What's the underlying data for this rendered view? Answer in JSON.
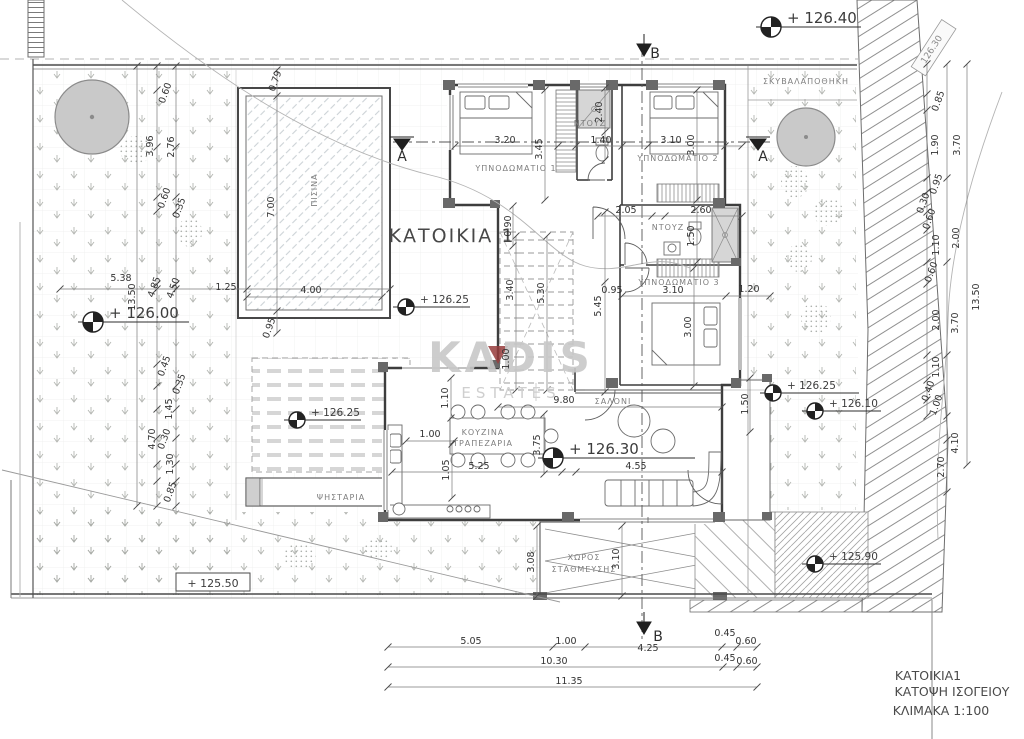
{
  "drawing": {
    "title": "ΚΑΤΟΙΚΙΑ 1",
    "watermark_line1": "KADIS",
    "watermark_line2": "ESTATES",
    "title_block": [
      "ΚΑΤΟΙΚΙΑ1",
      "ΚΑΤΟΨΗ ΙΣΟΓΕΙΟΥ",
      "ΚΛΙΜΑΚΑ 1:100"
    ],
    "accent_color": "#973c3c",
    "ink_color": "#3d3d3d"
  },
  "labels": [
    {
      "t": "ΚΑΤΟΙΚΙΑ 1",
      "x": 452,
      "y": 242,
      "c": "title",
      "n": "plan-title"
    },
    {
      "t": "KADIS",
      "x": 511,
      "y": 372,
      "c": "wm",
      "n": "watermark-kadis"
    },
    {
      "t": "ESTATES",
      "x": 511,
      "y": 398,
      "c": "wm2",
      "n": "watermark-estates"
    },
    {
      "t": "ΚΑΤΟΙΚΙΑ1",
      "x": 928,
      "y": 680,
      "c": "tb",
      "n": "titleblock-house"
    },
    {
      "t": "ΚΑΤΟΨΗ ΙΣΟΓΕΙΟΥ",
      "x": 952,
      "y": 696,
      "c": "tb",
      "n": "titleblock-plan"
    },
    {
      "t": "ΚΛΙΜΑΚΑ 1:100",
      "x": 941,
      "y": 715,
      "c": "tb",
      "n": "titleblock-scale"
    },
    {
      "t": "ΥΠΝΟΔΩΜΑΤΙΟ 1",
      "x": 516,
      "y": 171,
      "c": "room",
      "n": "room-bedroom-1"
    },
    {
      "t": "ΥΠΝΟΔΩΜΑΤΙΟ 2",
      "x": 678,
      "y": 161,
      "c": "room",
      "n": "room-bedroom-2"
    },
    {
      "t": "ΥΠΝΟΔΩΜΑΤΙΟ 3",
      "x": 679,
      "y": 285,
      "c": "room",
      "n": "room-bedroom-3"
    },
    {
      "t": "ΝΤΟΥΖ",
      "x": 590,
      "y": 126,
      "c": "room",
      "n": "room-shower-1"
    },
    {
      "t": "ΝΤΟΥΖ",
      "x": 668,
      "y": 230,
      "c": "room",
      "n": "room-shower-2"
    },
    {
      "t": "ΚΟΥΖΙΝΑ",
      "x": 483,
      "y": 435,
      "c": "room",
      "n": "room-kitchen"
    },
    {
      "t": "ΤΡΑΠΕΖΑΡΙΑ",
      "x": 483,
      "y": 446,
      "c": "room",
      "n": "room-dining"
    },
    {
      "t": "ΣΑΛΟΝΙ",
      "x": 613,
      "y": 404,
      "c": "room",
      "n": "room-living"
    },
    {
      "t": "ΨΗΣΤΑΡΙΑ",
      "x": 341,
      "y": 500,
      "c": "room",
      "n": "room-bbq"
    },
    {
      "t": "ΧΩΡΟΣ",
      "x": 584,
      "y": 560,
      "c": "room",
      "n": "room-parking-1"
    },
    {
      "t": "ΣΤΑΘΜΕΥΣΗΣ",
      "x": 584,
      "y": 572,
      "c": "room",
      "n": "room-parking-2"
    },
    {
      "t": "ΣΚΥΒΑΛΑΠΟΘΗΚΗ",
      "x": 806,
      "y": 84,
      "c": "room",
      "n": "room-garbage-store"
    },
    {
      "t": "ΠΙΣΙΝΑ",
      "x": 317,
      "y": 190,
      "r": -90,
      "c": "room",
      "n": "room-pool"
    },
    {
      "t": "A",
      "x": 402,
      "y": 161,
      "c": "sec",
      "n": "section-a-left"
    },
    {
      "t": "A",
      "x": 763,
      "y": 161,
      "c": "sec",
      "n": "section-a-right"
    },
    {
      "t": "B",
      "x": 655,
      "y": 58,
      "c": "sec",
      "n": "section-b-top"
    },
    {
      "t": "B",
      "x": 658,
      "y": 641,
      "c": "sec",
      "n": "section-b-bottom"
    },
    {
      "t": "126.30",
      "x": 934,
      "y": 51,
      "r": -57,
      "c": "sign",
      "n": "road-level-sign"
    },
    {
      "t": "3.20",
      "x": 505,
      "y": 143
    },
    {
      "t": "1.40",
      "x": 601,
      "y": 143
    },
    {
      "t": "3.10",
      "x": 671,
      "y": 143
    },
    {
      "t": "3.45",
      "x": 542,
      "y": 149,
      "r": -90
    },
    {
      "t": "2.40",
      "x": 602,
      "y": 112,
      "r": -90
    },
    {
      "t": "3.00",
      "x": 694,
      "y": 145,
      "r": -90
    },
    {
      "t": "0.90",
      "x": 511,
      "y": 226,
      "r": -90
    },
    {
      "t": "2.05",
      "x": 626,
      "y": 213
    },
    {
      "t": "2.60",
      "x": 701,
      "y": 213
    },
    {
      "t": "1.50",
      "x": 694,
      "y": 236,
      "r": -90
    },
    {
      "t": "3.10",
      "x": 673,
      "y": 293
    },
    {
      "t": "1.20",
      "x": 749,
      "y": 292
    },
    {
      "t": "3.00",
      "x": 691,
      "y": 327,
      "r": -90
    },
    {
      "t": "0.95",
      "x": 612,
      "y": 293
    },
    {
      "t": "5.45",
      "x": 601,
      "y": 306,
      "r": -90
    },
    {
      "t": "3.40",
      "x": 513,
      "y": 290,
      "r": -90
    },
    {
      "t": "5.30",
      "x": 544,
      "y": 293,
      "r": -90
    },
    {
      "t": "1.00",
      "x": 509,
      "y": 359,
      "r": -90
    },
    {
      "t": "9.80",
      "x": 564,
      "y": 403
    },
    {
      "t": "1.10",
      "x": 448,
      "y": 398,
      "r": -90
    },
    {
      "t": "1.00",
      "x": 430,
      "y": 437
    },
    {
      "t": "3.75",
      "x": 540,
      "y": 445,
      "r": -90
    },
    {
      "t": "1.05",
      "x": 449,
      "y": 470,
      "r": -90
    },
    {
      "t": "5.25",
      "x": 479,
      "y": 469
    },
    {
      "t": "4.55",
      "x": 636,
      "y": 469
    },
    {
      "t": "1.50",
      "x": 748,
      "y": 404,
      "r": -90
    },
    {
      "t": "3.08",
      "x": 534,
      "y": 562,
      "r": -90
    },
    {
      "t": "3.10",
      "x": 619,
      "y": 559,
      "r": -90
    },
    {
      "t": "0.79",
      "x": 278,
      "y": 82,
      "r": -70
    },
    {
      "t": "7.00",
      "x": 274,
      "y": 207,
      "r": -90
    },
    {
      "t": "4.00",
      "x": 311,
      "y": 293
    },
    {
      "t": "1.25",
      "x": 226,
      "y": 290
    },
    {
      "t": "0.95",
      "x": 272,
      "y": 329,
      "r": -70
    },
    {
      "t": "5.38",
      "x": 121,
      "y": 281
    },
    {
      "t": "13.50",
      "x": 135,
      "y": 297,
      "r": -90
    },
    {
      "t": "4.85",
      "x": 157,
      "y": 288,
      "r": -70
    },
    {
      "t": "4.50",
      "x": 176,
      "y": 289,
      "r": -70
    },
    {
      "t": "0.60",
      "x": 168,
      "y": 94,
      "r": -70
    },
    {
      "t": "3.96",
      "x": 153,
      "y": 146,
      "r": -90
    },
    {
      "t": "2.76",
      "x": 174,
      "y": 147,
      "r": -90
    },
    {
      "t": "0.60",
      "x": 167,
      "y": 199,
      "r": -70
    },
    {
      "t": "0.35",
      "x": 182,
      "y": 209,
      "r": -70
    },
    {
      "t": "0.45",
      "x": 167,
      "y": 367,
      "r": -70
    },
    {
      "t": "0.35",
      "x": 182,
      "y": 385,
      "r": -70
    },
    {
      "t": "1.45",
      "x": 172,
      "y": 409,
      "r": -90
    },
    {
      "t": "4.70",
      "x": 155,
      "y": 439,
      "r": -90
    },
    {
      "t": "0.30",
      "x": 167,
      "y": 440,
      "r": -70
    },
    {
      "t": "1.30",
      "x": 173,
      "y": 464,
      "r": -90
    },
    {
      "t": "0.85",
      "x": 173,
      "y": 493,
      "r": -70
    },
    {
      "t": "5.05",
      "x": 471,
      "y": 644
    },
    {
      "t": "1.00",
      "x": 566,
      "y": 644
    },
    {
      "t": "4.25",
      "x": 648,
      "y": 651
    },
    {
      "t": "0.45",
      "x": 725,
      "y": 636
    },
    {
      "t": "0.60",
      "x": 746,
      "y": 644
    },
    {
      "t": "10.30",
      "x": 554,
      "y": 664
    },
    {
      "t": "0.45",
      "x": 725,
      "y": 661
    },
    {
      "t": "0.60",
      "x": 747,
      "y": 664
    },
    {
      "t": "11.35",
      "x": 569,
      "y": 684
    },
    {
      "t": "0.85",
      "x": 941,
      "y": 102,
      "r": -70
    },
    {
      "t": "1.90",
      "x": 938,
      "y": 145,
      "r": -90
    },
    {
      "t": "3.70",
      "x": 960,
      "y": 145,
      "r": -90
    },
    {
      "t": "0.95",
      "x": 939,
      "y": 185,
      "r": -70
    },
    {
      "t": "0.30",
      "x": 926,
      "y": 204,
      "r": -70
    },
    {
      "t": "0.60",
      "x": 932,
      "y": 220,
      "r": -70
    },
    {
      "t": "1.10",
      "x": 939,
      "y": 245,
      "r": -90
    },
    {
      "t": "2.00",
      "x": 959,
      "y": 238,
      "r": -90
    },
    {
      "t": "0.60",
      "x": 934,
      "y": 273,
      "r": -70
    },
    {
      "t": "2.00",
      "x": 939,
      "y": 320,
      "r": -90
    },
    {
      "t": "3.70",
      "x": 958,
      "y": 323,
      "r": -90
    },
    {
      "t": "13.50",
      "x": 979,
      "y": 297,
      "r": -90
    },
    {
      "t": "1.10",
      "x": 939,
      "y": 367,
      "r": -90
    },
    {
      "t": "0.40",
      "x": 931,
      "y": 392,
      "r": -70
    },
    {
      "t": "1.00",
      "x": 939,
      "y": 406,
      "r": -70
    },
    {
      "t": "4.10",
      "x": 958,
      "y": 443,
      "r": -90
    },
    {
      "t": "2.70",
      "x": 944,
      "y": 467,
      "r": -90
    }
  ],
  "elevation_markers": [
    {
      "v": "126.40",
      "x": 771,
      "y": 27,
      "len": 90,
      "fs": 15
    },
    {
      "v": "126.00",
      "x": 93,
      "y": 322,
      "len": 96,
      "fs": 15
    },
    {
      "v": "126.25",
      "x": 406,
      "y": 307,
      "len": 64,
      "fs": 10.5
    },
    {
      "v": "126.25",
      "x": 297,
      "y": 420,
      "len": 64,
      "fs": 10.5
    },
    {
      "v": "126.30",
      "x": 553,
      "y": 458,
      "len": 142,
      "fs": 15
    },
    {
      "v": "126.25",
      "x": 773,
      "y": 393,
      "len": 86,
      "fs": 10.5
    },
    {
      "v": "126.10",
      "x": 815,
      "y": 411,
      "len": 66,
      "fs": 10.5
    },
    {
      "v": "125.90",
      "x": 815,
      "y": 564,
      "len": 66,
      "fs": 10.5
    },
    {
      "v": "125.50",
      "x": 213,
      "y": 585,
      "fs": 11,
      "boxed": true
    }
  ],
  "dim_chains": [
    {
      "o": "h",
      "y": 647,
      "x1": 388,
      "x2": 757,
      "ticks": [
        388,
        553,
        585,
        722,
        737,
        757
      ]
    },
    {
      "o": "h",
      "y": 667,
      "x1": 388,
      "x2": 757,
      "ticks": [
        388,
        723,
        737,
        757
      ]
    },
    {
      "o": "h",
      "y": 687,
      "x1": 388,
      "x2": 757,
      "ticks": [
        388,
        757
      ]
    },
    {
      "o": "v",
      "x": 157,
      "y1": 66,
      "y2": 506,
      "ticks": [
        66,
        90,
        147,
        197,
        211,
        284,
        364,
        386,
        409,
        438,
        464,
        481,
        506
      ]
    },
    {
      "o": "v",
      "x": 176,
      "y1": 66,
      "y2": 506,
      "ticks": [
        66,
        147,
        197,
        211,
        284,
        386,
        409,
        438,
        464,
        481,
        506
      ]
    },
    {
      "o": "v",
      "x": 137,
      "y1": 66,
      "y2": 506,
      "ticks": [
        66,
        506
      ]
    },
    {
      "o": "h",
      "y": 289,
      "x1": 60,
      "x2": 390,
      "ticks": [
        60,
        157,
        176,
        247,
        390
      ]
    },
    {
      "o": "v",
      "x": 277,
      "y1": 70,
      "y2": 333,
      "ticks": [
        70,
        96,
        311,
        333
      ]
    },
    {
      "o": "h",
      "y": 297,
      "x1": 247,
      "x2": 382,
      "ticks": [
        247,
        382
      ]
    },
    {
      "o": "v",
      "x": 927,
      "y1": 64,
      "y2": 416,
      "ticks": [
        64,
        94,
        110,
        178,
        192,
        212,
        230,
        262,
        284,
        355,
        380,
        400,
        416
      ]
    },
    {
      "o": "v",
      "x": 947,
      "y1": 64,
      "y2": 492,
      "ticks": [
        64,
        178,
        262,
        355,
        416,
        440,
        492
      ]
    },
    {
      "o": "v",
      "x": 967,
      "y1": 64,
      "y2": 465,
      "ticks": [
        64,
        465
      ]
    },
    {
      "o": "h",
      "y": 216,
      "x1": 598,
      "x2": 742,
      "ticks": [
        598,
        652,
        665,
        742
      ]
    },
    {
      "o": "h",
      "y": 146,
      "x1": 455,
      "x2": 742,
      "ticks": [
        455,
        558,
        576,
        622,
        648,
        725,
        742
      ]
    },
    {
      "o": "h",
      "y": 296,
      "x1": 622,
      "x2": 770,
      "ticks": [
        622,
        726,
        770
      ]
    },
    {
      "o": "h",
      "y": 407,
      "x1": 498,
      "x2": 722,
      "ticks": [
        498,
        722
      ]
    },
    {
      "o": "h",
      "y": 472,
      "x1": 392,
      "x2": 722,
      "ticks": [
        392,
        562,
        576,
        722
      ]
    },
    {
      "o": "v",
      "x": 516,
      "y1": 236,
      "y2": 390,
      "ticks": [
        236,
        390
      ]
    },
    {
      "o": "v",
      "x": 547,
      "y1": 236,
      "y2": 390,
      "ticks": [
        236,
        390
      ]
    },
    {
      "o": "v",
      "x": 605,
      "y1": 212,
      "y2": 392,
      "ticks": [
        212,
        282,
        392
      ]
    },
    {
      "o": "v",
      "x": 545,
      "y1": 90,
      "y2": 200,
      "ticks": [
        90,
        200
      ]
    },
    {
      "o": "v",
      "x": 605,
      "y1": 88,
      "y2": 160,
      "ticks": [
        88,
        132,
        160
      ]
    },
    {
      "o": "v",
      "x": 697,
      "y1": 90,
      "y2": 200,
      "ticks": [
        90,
        200
      ]
    },
    {
      "o": "v",
      "x": 694,
      "y1": 268,
      "y2": 386,
      "ticks": [
        268,
        386
      ]
    },
    {
      "o": "v",
      "x": 451,
      "y1": 378,
      "y2": 418,
      "ticks": [
        378,
        418
      ]
    },
    {
      "o": "v",
      "x": 544,
      "y1": 414,
      "y2": 474,
      "ticks": [
        414,
        474
      ]
    },
    {
      "o": "v",
      "x": 452,
      "y1": 444,
      "y2": 498,
      "ticks": [
        444,
        498
      ]
    },
    {
      "o": "v",
      "x": 750,
      "y1": 378,
      "y2": 432,
      "ticks": [
        378,
        432
      ]
    },
    {
      "o": "v",
      "x": 537,
      "y1": 526,
      "y2": 596,
      "ticks": [
        526,
        596
      ]
    },
    {
      "o": "v",
      "x": 622,
      "y1": 526,
      "y2": 596,
      "ticks": [
        526,
        596
      ]
    },
    {
      "o": "h",
      "y": 441,
      "x1": 406,
      "x2": 454,
      "ticks": [
        406,
        454
      ]
    },
    {
      "o": "v",
      "x": 513,
      "y1": 206,
      "y2": 246,
      "ticks": [
        206,
        246
      ]
    },
    {
      "o": "v",
      "x": 697,
      "y1": 208,
      "y2": 262,
      "ticks": [
        208,
        262
      ]
    }
  ]
}
